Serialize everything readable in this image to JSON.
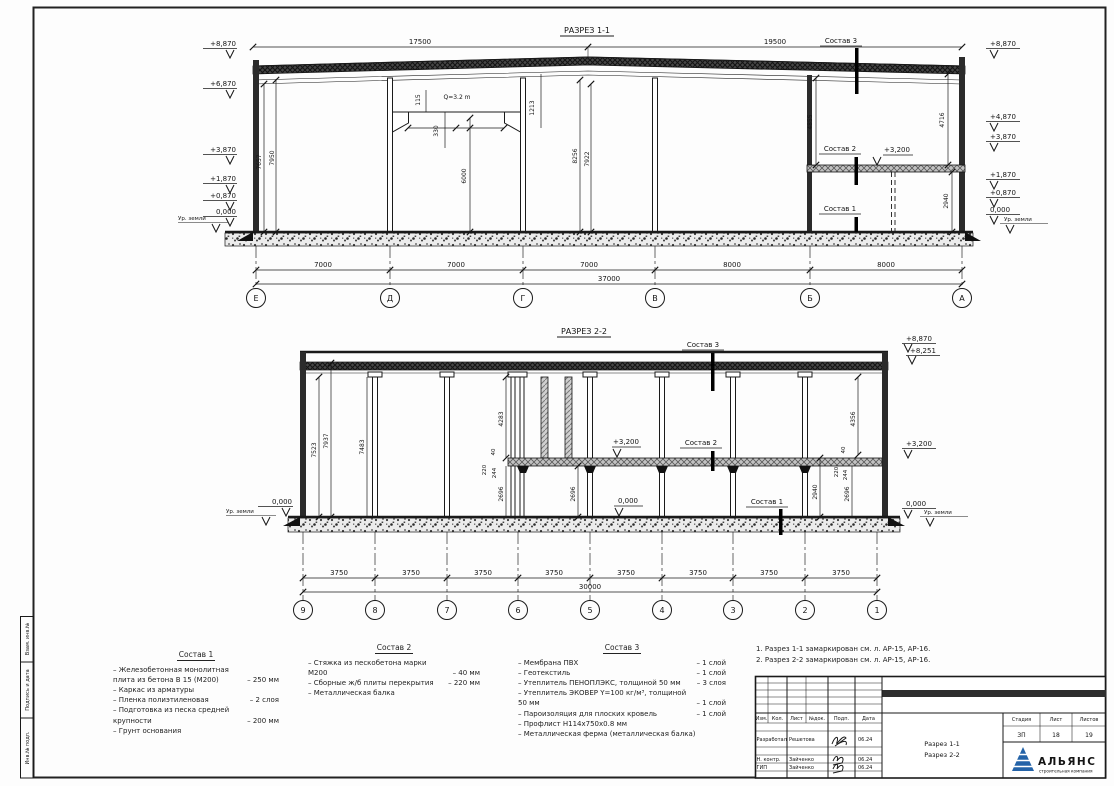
{
  "colors": {
    "logo_blue": "#2463a8",
    "logo_red": "#c64a3f"
  },
  "frame": {
    "stamps": [
      "Взам. инв.№",
      "Подпись и дата",
      "Инв.№ подл."
    ]
  },
  "s1": {
    "title": "РАЗРЕЗ 1-1",
    "elev_left": [
      "+8,870",
      "+6,870",
      "+3,870",
      "+1,870",
      "+0,870",
      "0,000"
    ],
    "elev_right": [
      "+8,870",
      "+4,870",
      "+3,870",
      "+1,870",
      "+0,870",
      "0,000"
    ],
    "ground": "Ур. земли",
    "top_dims": [
      "17500",
      "19500"
    ],
    "span_dims": [
      "7000",
      "7000",
      "7000",
      "8000",
      "8000"
    ],
    "total": "37000",
    "axes": [
      "Е",
      "Д",
      "Г",
      "В",
      "Б",
      "А"
    ],
    "crane": "Q=3.2 m",
    "lvl": "+3,200",
    "flags": [
      "Состав 1",
      "Состав 2",
      "Состав 3"
    ],
    "vd": {
      "v7657": "7657",
      "v7950": "7950",
      "v115": "115",
      "v330": "330",
      "v6000": "6000",
      "v1213": "1213",
      "v8256": "8256",
      "v7922": "7922",
      "v4855": "4855",
      "v4716": "4716",
      "v2940": "2940"
    }
  },
  "s2": {
    "title": "РАЗРЕЗ 2-2",
    "elev_right": [
      "+8,870",
      "+8,251",
      "+3,200",
      "0,000"
    ],
    "zero": "0,000",
    "lvl": "+3,200",
    "ground": "Ур. земли",
    "span_dims": [
      "3750",
      "3750",
      "3750",
      "3750",
      "3750",
      "3750",
      "3750",
      "3750"
    ],
    "total": "30000",
    "axes": [
      "9",
      "8",
      "7",
      "6",
      "5",
      "4",
      "3",
      "2",
      "1"
    ],
    "flags": [
      "Состав 1",
      "Состав 2",
      "Состав 3"
    ],
    "vd": {
      "v7523": "7523",
      "v7937": "7937",
      "v7483": "7483",
      "v4283": "4283",
      "v40a": "40",
      "v220a": "220",
      "v244a": "244",
      "v2696a": "2696",
      "v2696b": "2696",
      "v2940": "2940",
      "v2696c": "2696",
      "v4356": "4356",
      "v40b": "40",
      "v220b": "220",
      "v244b": "244"
    }
  },
  "specs": [
    {
      "title": "Состав 1",
      "items": [
        {
          "t": "– Железобетонная  монолитная плита из бетона В 15 (М200)",
          "v": "– 250 мм"
        },
        {
          "t": "– Каркас из арматуры",
          "v": ""
        },
        {
          "t": "– Пленка полиэтиленовая",
          "v": "– 2 слоя"
        },
        {
          "t": "– Подготовка из песка средней крупности",
          "v": "– 200 мм"
        },
        {
          "t": "– Грунт основания",
          "v": ""
        }
      ]
    },
    {
      "title": "Состав 2",
      "items": [
        {
          "t": "– Стяжка из пескобетона марки М200",
          "v": "– 40 мм"
        },
        {
          "t": "– Сборные ж/б плиты перекрытия",
          "v": "– 220 мм"
        },
        {
          "t": "– Металлическая балка",
          "v": ""
        }
      ]
    },
    {
      "title": "Состав 3",
      "items": [
        {
          "t": "– Мембрана ПВХ",
          "v": "– 1 слой"
        },
        {
          "t": "– Геотекстиль",
          "v": "– 1 слой"
        },
        {
          "t": "– Утеплитель ПЕНОПЛЭКС, толщиной 50 мм",
          "v": "– 3 слоя"
        },
        {
          "t": "– Утеплитель ЭКОВЕР Y=100 кг/м³, толщиной 50 мм",
          "v": "– 1 слой"
        },
        {
          "t": "– Пароизоляция для плоских кровель",
          "v": "– 1 слой"
        },
        {
          "t": "– Профлист  Н114х750х0.8 мм",
          "v": ""
        },
        {
          "t": "– Металлическая ферма (металлическая балка)",
          "v": ""
        }
      ]
    }
  ],
  "notes": [
    "1. Разрез 1-1 замаркирован см. л. АР-15, АР-16.",
    "2. Разрез 2-2 замаркирован см. л. АР-15, АР-16."
  ],
  "tb": {
    "cols": [
      "Изм.",
      "Кол.",
      "Лист",
      "№док.",
      "Подп.",
      "Дата"
    ],
    "rows": [
      {
        "role": "Разработал",
        "name": "Решетова",
        "date": "06.24"
      },
      {
        "role": "Н. контр.",
        "name": "Зайченко",
        "date": "06.24"
      },
      {
        "role": "ГИП",
        "name": "Зайченко",
        "date": "06.24"
      }
    ],
    "doc1": "Разрез 1-1",
    "doc2": "Разрез 2-2",
    "stage_h": "Стадия",
    "sheet_h": "Лист",
    "sheets_h": "Листов",
    "stage": "ЗП",
    "sheet": "18",
    "sheets": "19",
    "org": "АЛЬЯНС",
    "org_sub": "строительная компания"
  }
}
